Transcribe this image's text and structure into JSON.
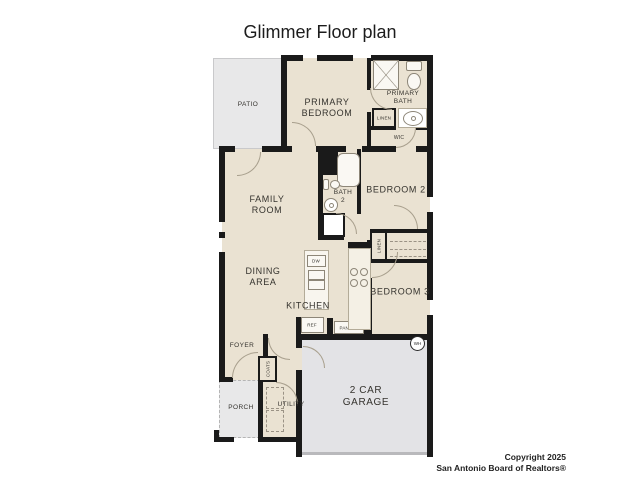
{
  "title": "Glimmer Floor plan",
  "rooms": {
    "patio": "PATIO",
    "primary_bedroom": "PRIMARY BEDROOM",
    "primary_bath": "PRIMARY BATH",
    "family_room": "FAMILY ROOM",
    "bath2": "BATH 2",
    "bedroom2": "BEDROOM 2",
    "dining": "DINING AREA",
    "kitchen": "KITCHEN",
    "bedroom3": "BEDROOM 3",
    "foyer": "FOYER",
    "porch": "PORCH",
    "utility": "UTILITY",
    "garage": "2 CAR GARAGE"
  },
  "closets": {
    "linen_primary": "LINEN",
    "linen_hall": "LINEN",
    "wic": "WIC",
    "coats": "COATS",
    "pantry": "PANTRY"
  },
  "appliances": {
    "dw": "DW",
    "ref": "REF",
    "wh": "WH"
  },
  "footer": {
    "line1": "Copyright 2025",
    "line2": "San Antonio Board of Realtors®"
  },
  "colors": {
    "floor": "#eae2d2",
    "outdoor": "#e8e8e9",
    "garage": "#e3e3e6",
    "wall": "#1a1a1a",
    "fixture": "#8d8678",
    "text": "#35332e"
  }
}
